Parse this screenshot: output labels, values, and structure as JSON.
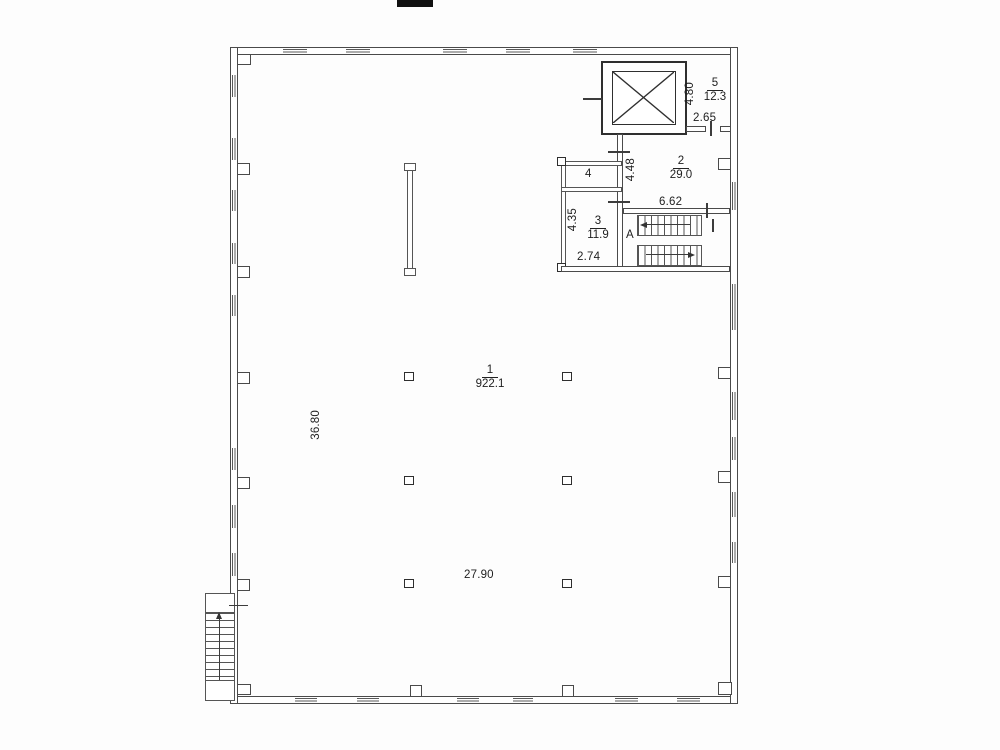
{
  "plan": {
    "hall": {
      "number": "1",
      "area": "922.1",
      "width_dim": "27.90",
      "depth_dim": "36.80"
    },
    "room2": {
      "number": "2",
      "area": "29.0",
      "width_dim": "6.62",
      "depth_dim": "4.48"
    },
    "room3": {
      "number": "3",
      "area": "11.9",
      "width_dim": "2.74",
      "depth_dim": "4.35"
    },
    "room4": {
      "number": "4"
    },
    "room5": {
      "number": "5",
      "area": "12.3",
      "width_dim": "2.65",
      "depth_dim": "4.80"
    },
    "stairwell": {
      "label": "A"
    }
  },
  "colors": {
    "line": "#3c3c3c",
    "background": "#fdfdfd"
  }
}
